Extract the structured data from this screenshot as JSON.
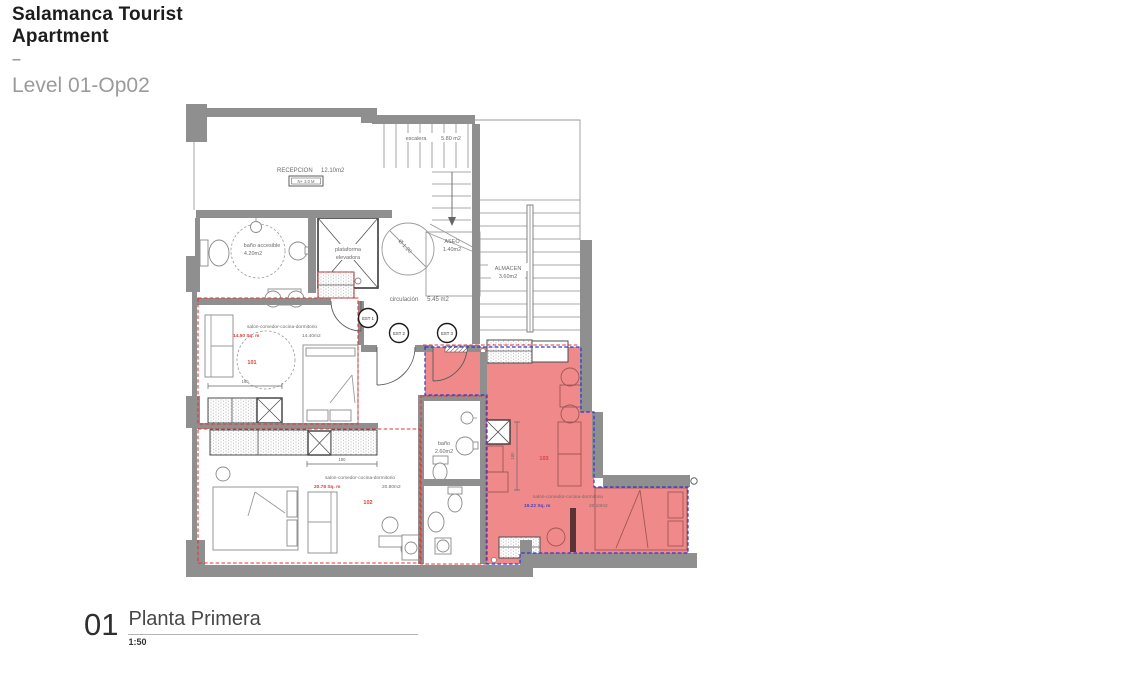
{
  "header": {
    "title_line1": "Salamanca Tourist",
    "title_line2": "Apartment",
    "separator": "–",
    "subtitle": "Level 01-Op02"
  },
  "footer": {
    "drawing_number": "01",
    "drawing_name": "Planta Primera",
    "scale": "1:50"
  },
  "colors": {
    "wall_gray": "#8f8f8f",
    "highlight_pink": "#f08a8a",
    "boundary_red": "#e03535",
    "boundary_blue": "#3535cc",
    "area_text_red": "#d84040",
    "area_text_blue": "#4343c9",
    "title_text": "#1d1d1d",
    "subtitle_text": "#9b9b9b"
  },
  "plan": {
    "rooms": {
      "recepcion": {
        "name": "RECEPCION",
        "area": "12.10m2",
        "level_tag": "N+ 3.0 M"
      },
      "escalera": {
        "name": "escalera",
        "area": "5.80 m2"
      },
      "aseo": {
        "name": "ASEO",
        "area": "1.40m2"
      },
      "almacen": {
        "name": "ALMACEN",
        "area": "3.60m2"
      },
      "bano_accesible": {
        "name": "baño accesible",
        "area": "4.20m2"
      },
      "plataforma": {
        "name_l1": "plataforma",
        "name_l2": "elevadora"
      },
      "circulacion": {
        "name": "circulación",
        "area": "5.45 m2"
      },
      "bano": {
        "name": "baño",
        "area": "2.60m2"
      }
    },
    "apartments": {
      "a101": {
        "number": "101",
        "use": "salon-comedor-cocina-dormitorio",
        "sqm": "14.50 Sq. m",
        "area": "14.40m2"
      },
      "a102": {
        "number": "102",
        "use": "salon-comedor-cocina-dormitorio",
        "sqm": "20.78 Sq. m",
        "area": "20.80m2"
      },
      "a103": {
        "number": "103",
        "use": "salon-comedor-cocina-dormitorio",
        "sqm": "19.22 Sq. m",
        "area": "20.10m2"
      }
    },
    "doors": {
      "est1": "EST 1",
      "est2": "EST 2",
      "est3": "EST 3"
    },
    "annotations": {
      "turning_diameter": "Ø 1.20",
      "dim_kitchen_101": "180",
      "dim_kitchen_102": "180",
      "dim_kitchen_103": "180"
    }
  }
}
